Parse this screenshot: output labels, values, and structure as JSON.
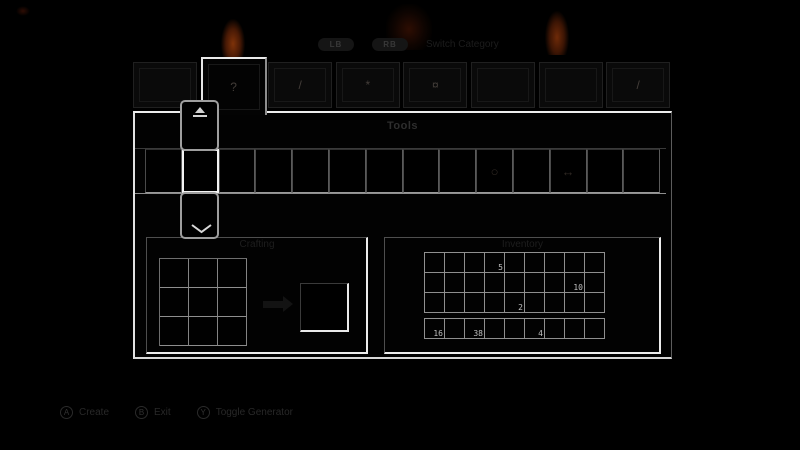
{
  "colors": {
    "background": "#000000",
    "panel_border_bright": "#ededed",
    "slot_grid_line": "#8e8e8e",
    "selection_highlight": "#f4f4f4",
    "flame_core": "#7e3209",
    "flame_outer": "#3c1504",
    "count_text": "#bfbfbf",
    "hint_text": "#282828",
    "title_text": "#2e2e2e"
  },
  "top_bar": {
    "left_bumper": "LB",
    "right_bumper": "RB",
    "hint_text": "Switch Category"
  },
  "tabs": [
    {
      "icon": "blank-icon",
      "glyph": "",
      "selected": false
    },
    {
      "icon": "tool-icon",
      "glyph": "?",
      "selected": true
    },
    {
      "icon": "sword-icon",
      "glyph": "/",
      "selected": false
    },
    {
      "icon": "ore-icon",
      "glyph": "*",
      "selected": false
    },
    {
      "icon": "item-icon",
      "glyph": "¤",
      "selected": false
    },
    {
      "icon": "blank-icon",
      "glyph": "",
      "selected": false
    },
    {
      "icon": "blank-icon",
      "glyph": "",
      "selected": false
    },
    {
      "icon": "hatchet-icon",
      "glyph": "/",
      "selected": false
    }
  ],
  "main": {
    "category_title": "Tools",
    "item_row": {
      "selected_index": 1,
      "slots": [
        {},
        {},
        {},
        {},
        {},
        {},
        {},
        {},
        {},
        {
          "icon": "clock-icon",
          "glyph": "○"
        },
        {},
        {
          "icon": "arrow-item-icon",
          "glyph": "↔"
        },
        {},
        {}
      ]
    },
    "crafting": {
      "title": "Crafting",
      "grid_size": "3x3"
    },
    "inventory": {
      "title": "Inventory",
      "cols": 9,
      "rows": 3,
      "counts": [
        {
          "row": 0,
          "col": 3,
          "value": "5"
        },
        {
          "row": 1,
          "col": 7,
          "value": "10"
        },
        {
          "row": 2,
          "col": 4,
          "value": "2"
        }
      ],
      "hotbar": [
        {
          "col": 0,
          "value": "16"
        },
        {
          "col": 2,
          "value": "38"
        },
        {
          "col": 5,
          "value": "4"
        }
      ]
    }
  },
  "icons": {
    "scroll_up": "up-arrow",
    "scroll_down": "down-chevron",
    "craft_arrow": "right-arrow"
  },
  "bottom_hints": [
    {
      "button": "A",
      "label": "Create"
    },
    {
      "button": "B",
      "label": "Exit"
    },
    {
      "button": "Y",
      "label": "Toggle Generator"
    }
  ]
}
